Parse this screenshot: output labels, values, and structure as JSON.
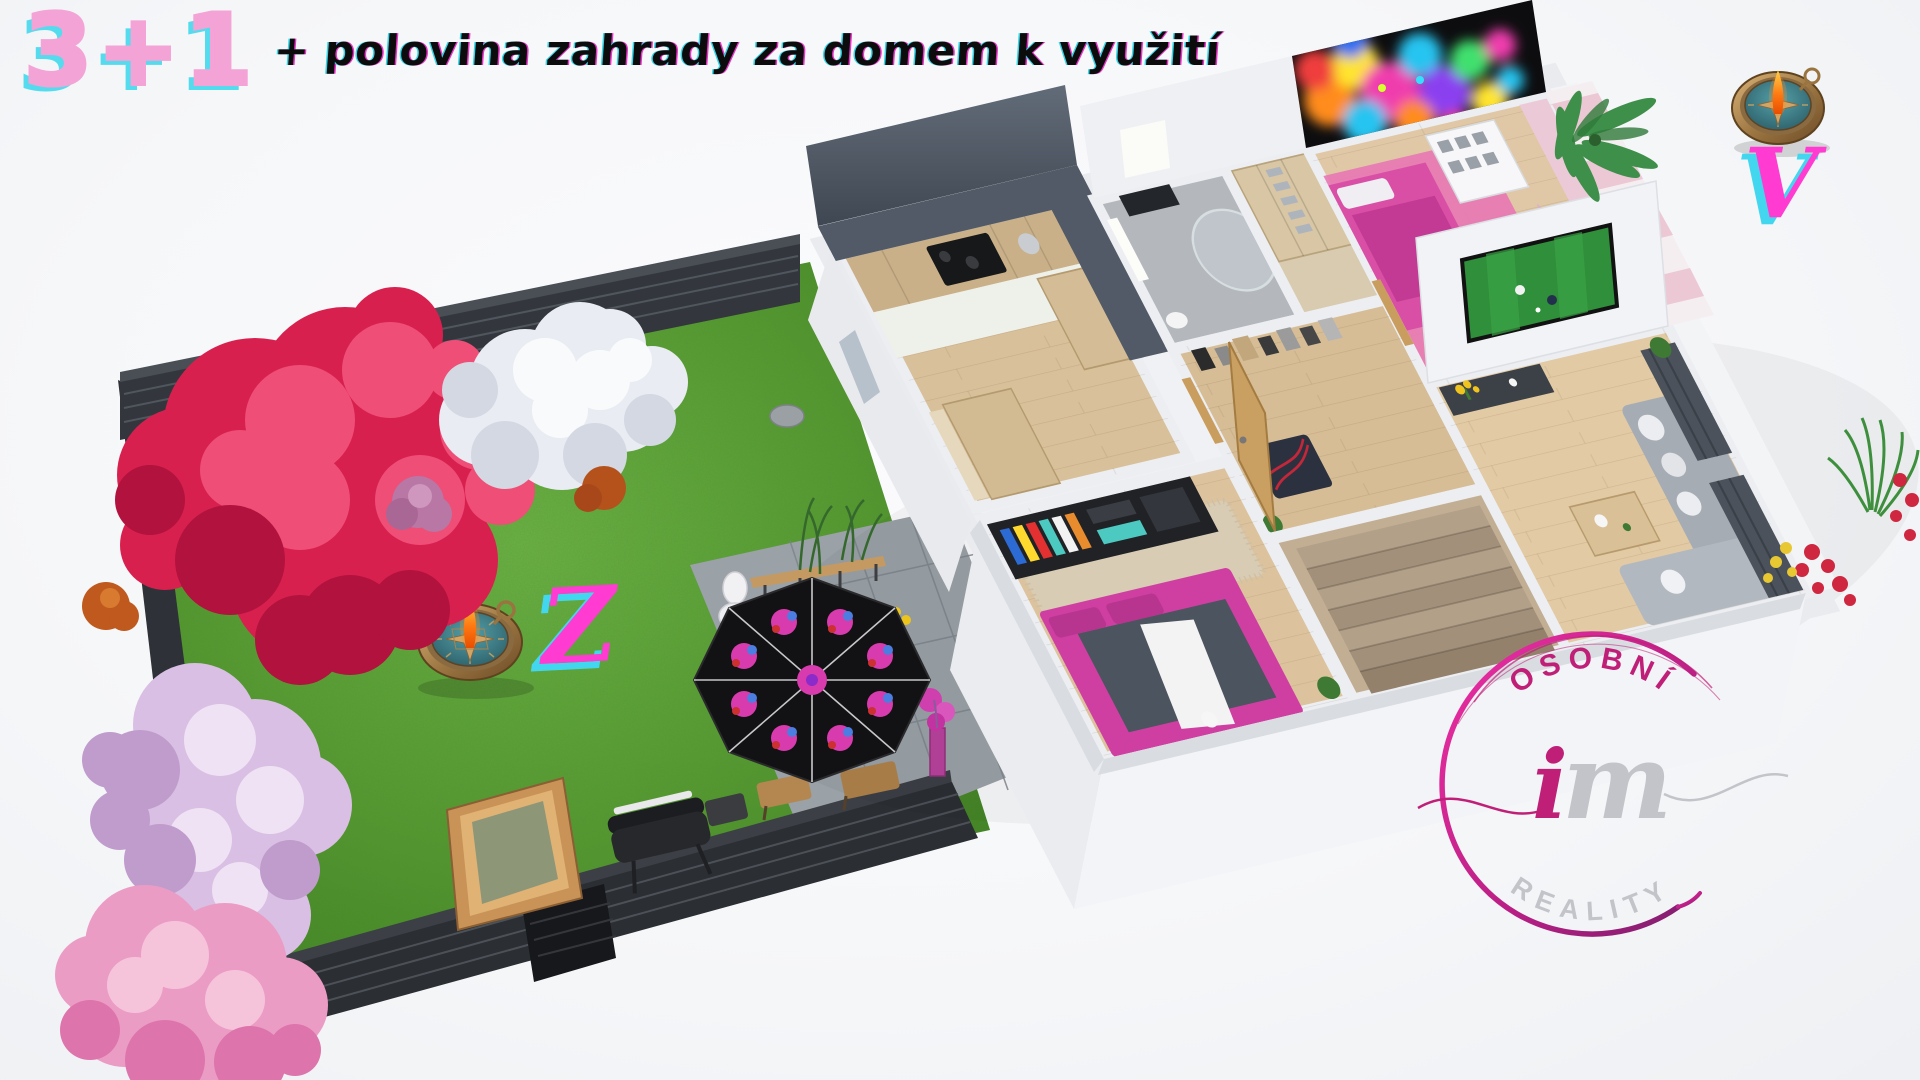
{
  "page": {
    "background_color": "#f7f8fa"
  },
  "header": {
    "badge": "3+1",
    "subtitle": "+ polovina zahrady za domem k využití",
    "badge_color": "#f4a3d6",
    "badge_shadow_color": "#55dbee",
    "subtitle_color": "#0c0c0c"
  },
  "orientation": {
    "west_label": "Z",
    "east_label": "V",
    "letter_color": "#ff3bd1",
    "letter_shadow_color": "#43d7ef",
    "garden_compass_icon": "compass-icon",
    "header_compass_icon": "compass-icon"
  },
  "logo": {
    "arc_top_text": "OSOBNÍ",
    "monogram_i": "i",
    "monogram_m": "m",
    "arc_bottom_text": "REALITY",
    "accent_color": "#c01f78",
    "muted_color": "#c3c4c9"
  },
  "palette": {
    "grass_green": "#54962d",
    "fence_dark": "#2f3338",
    "wood_floor": "#dcc49e",
    "wall_white": "#eef0f4",
    "bed_magenta": "#cf3fa2",
    "umbrella_black": "#121214",
    "umbrella_magenta": "#d83bad",
    "mural_black": "#0d0d0f",
    "tv_pitch_green": "#2f8f3a",
    "compass_bronze": "#9a7440",
    "compass_face_teal": "#37737c"
  }
}
